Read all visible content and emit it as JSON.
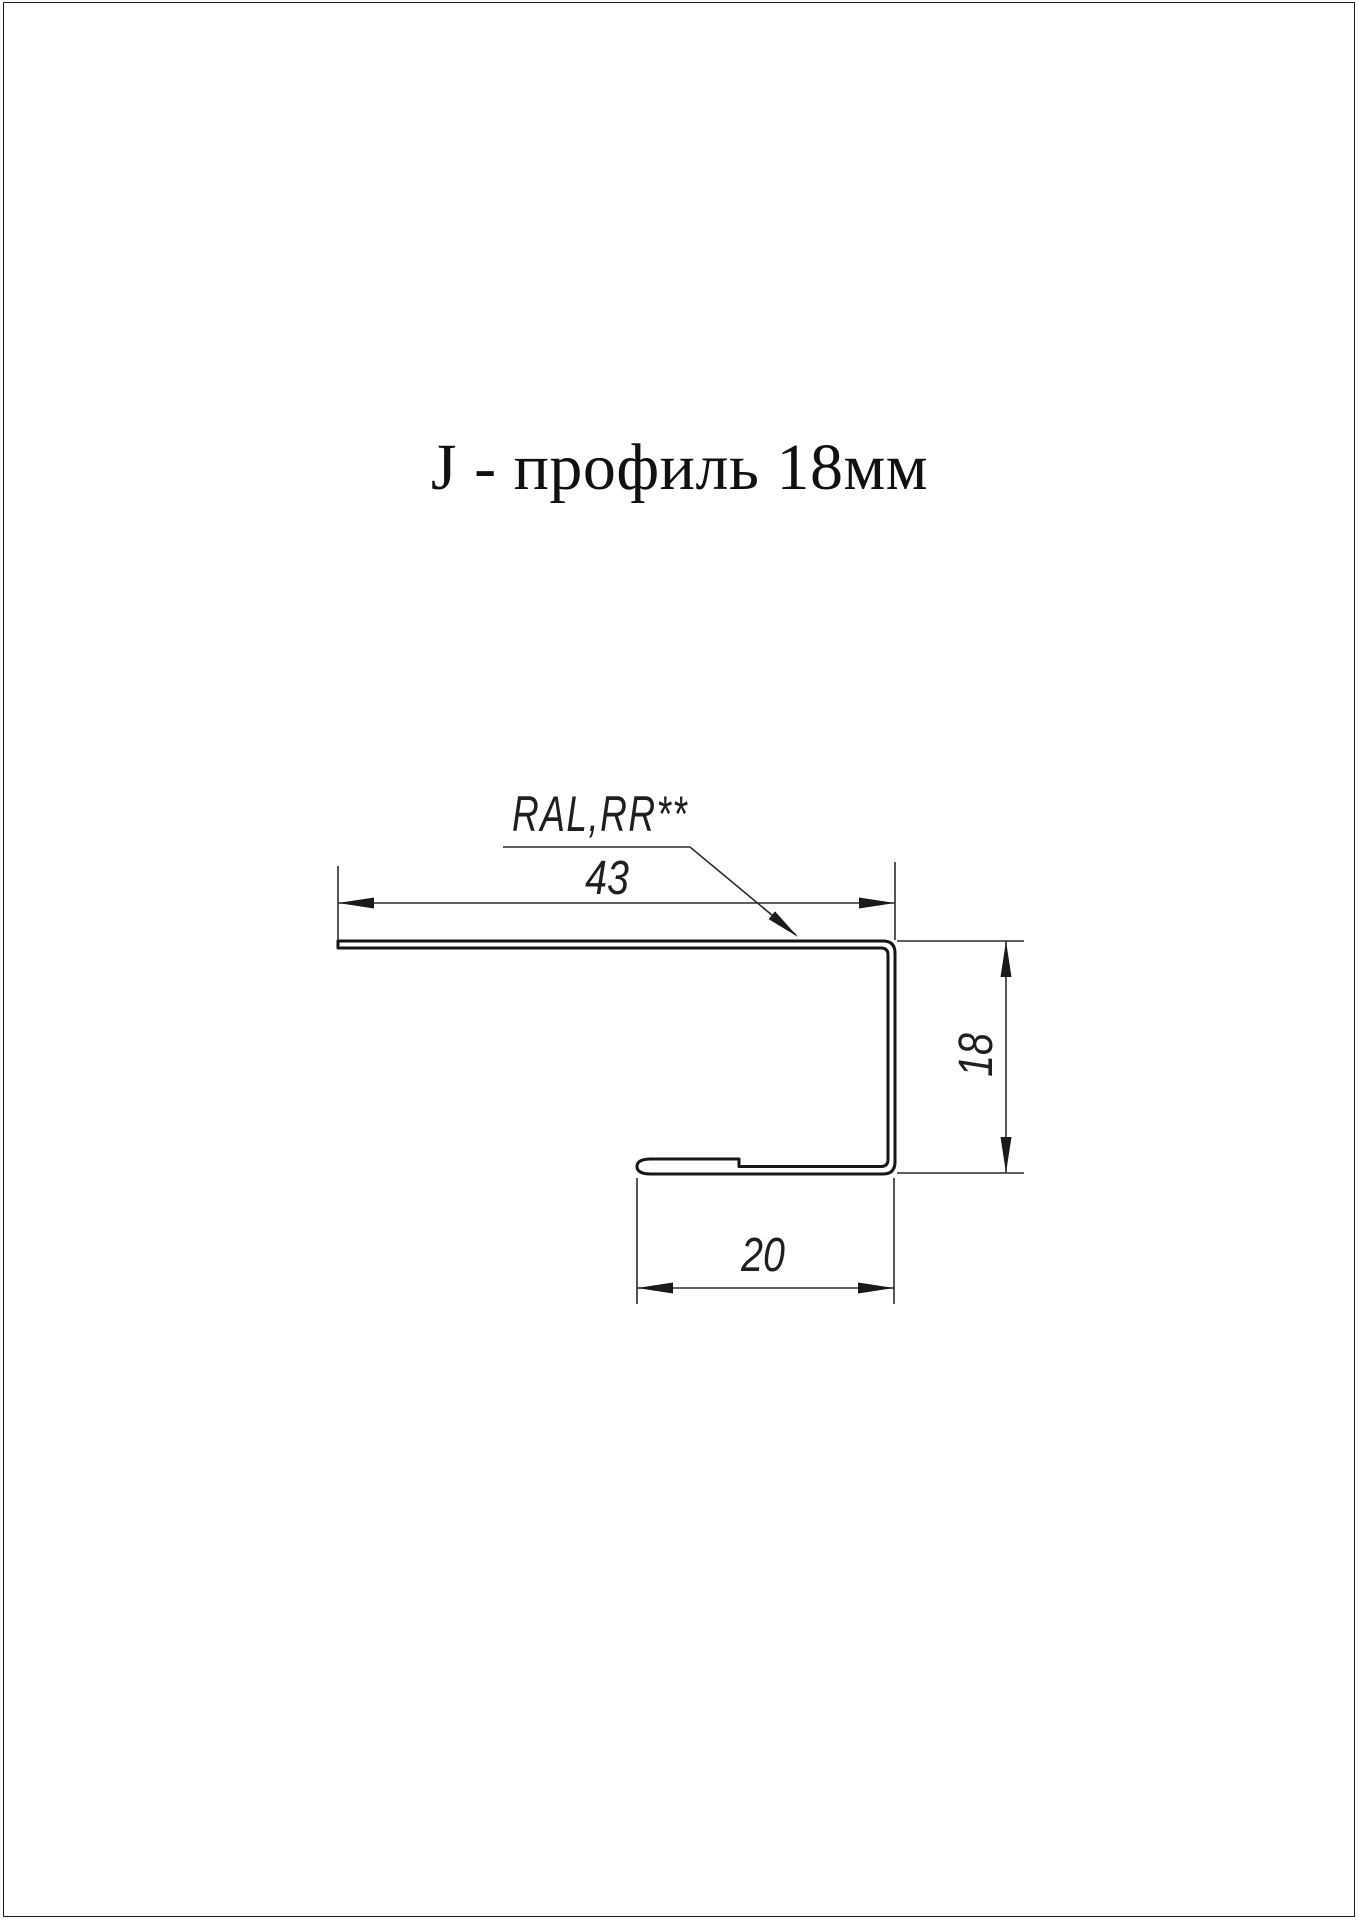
{
  "page": {
    "background": "#ffffff",
    "line_color": "#1c1c1c",
    "title": "J - профиль 18мм"
  },
  "drawing": {
    "coating_label": "RAL,RR**",
    "dimensions": {
      "flange_width": "43",
      "height": "18",
      "lip_width": "20"
    }
  }
}
